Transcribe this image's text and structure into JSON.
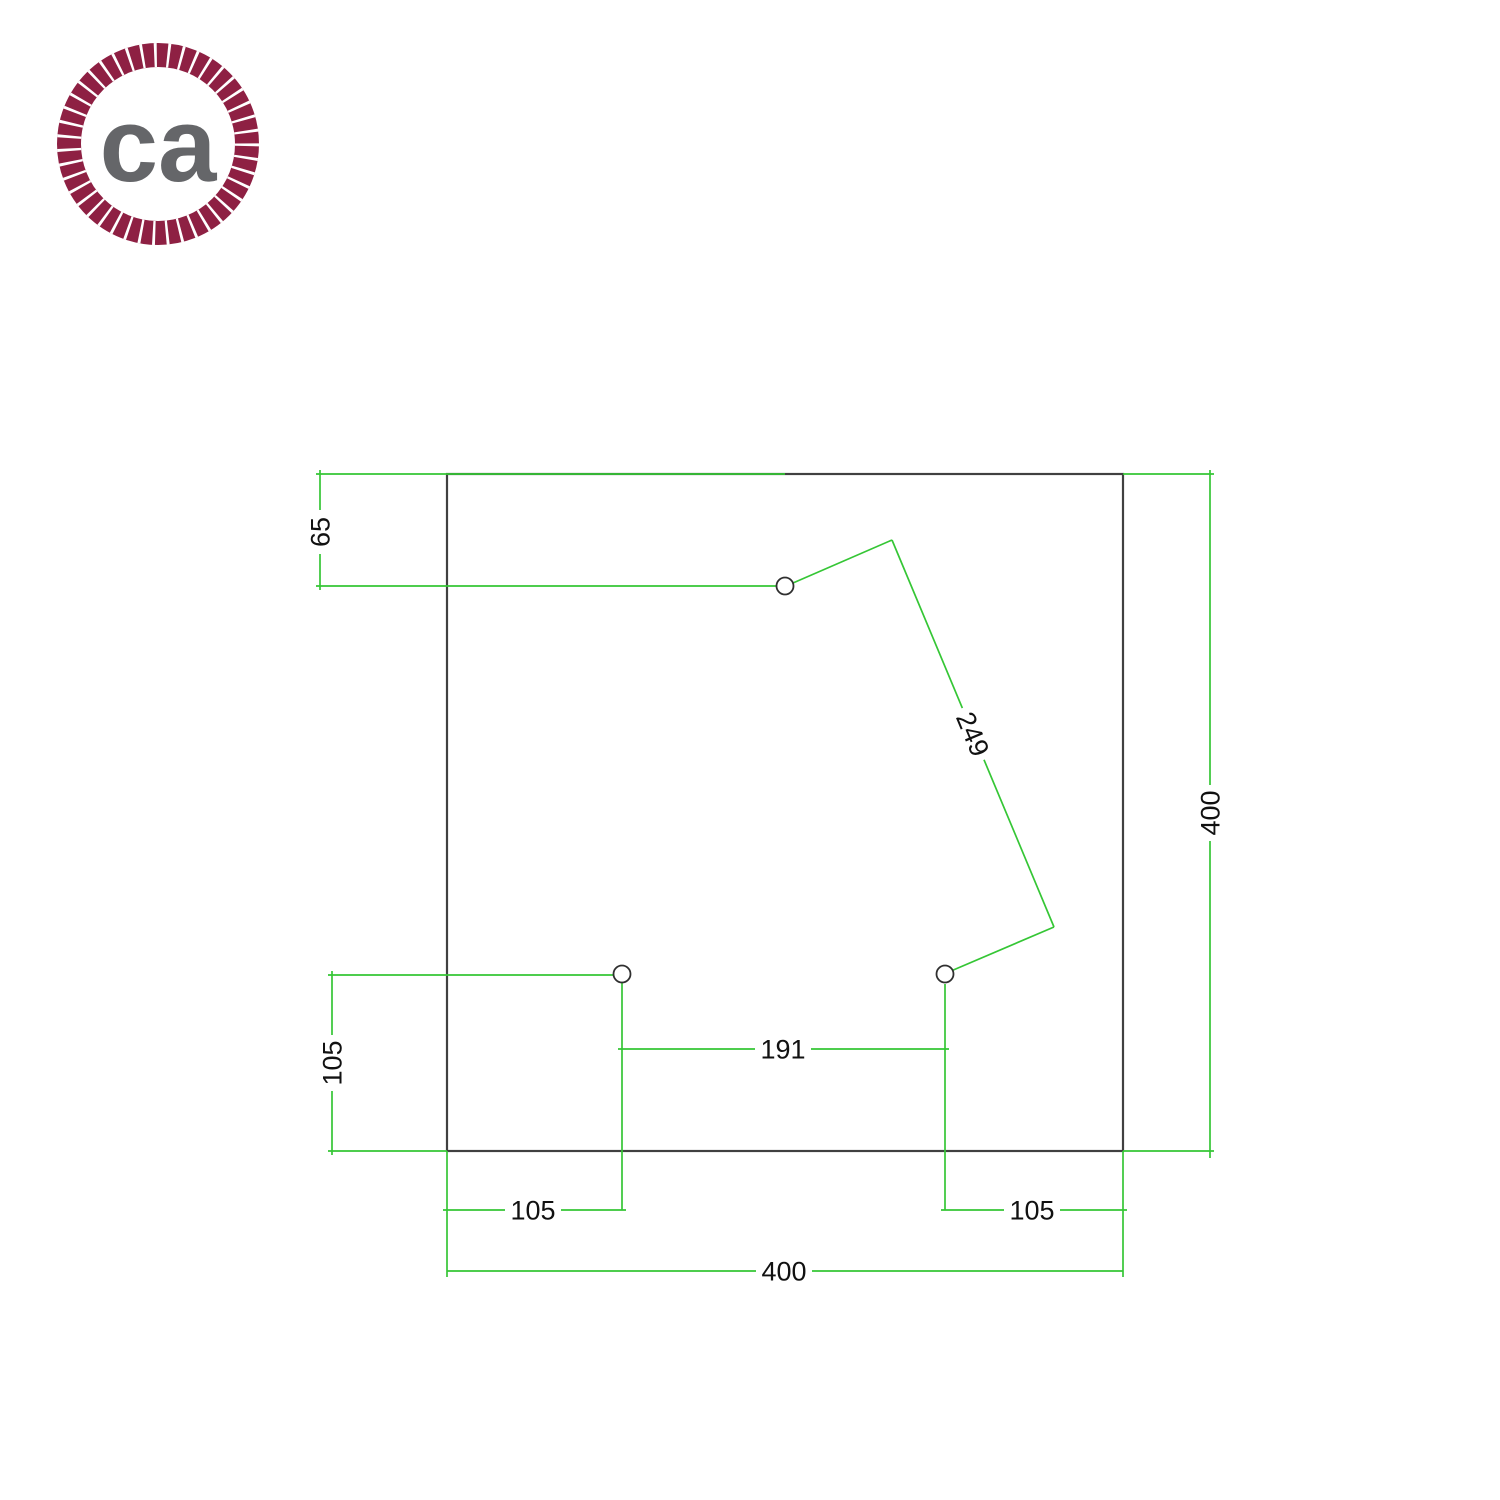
{
  "page": {
    "background": "#ffffff",
    "description": "Technical drilling template drawing of a square ceiling rose plate with 3 holes and CAD-style dimension lines"
  },
  "logo": {
    "text": "ca",
    "ring_color": "#8e2043",
    "text_color": "#656669"
  },
  "drawing": {
    "outline_color": "#404040",
    "dimension_line_color": "#35c635",
    "dimension_text_color": "#111111",
    "plate_shape": "square",
    "hole_count": 3,
    "labels": {
      "top_hole_offset": "65",
      "left_hole_offset": "105",
      "holes_spacing": "191",
      "diagonal_spacing": "249",
      "bottom_left_offset": "105",
      "bottom_right_offset": "105",
      "overall_width": "400",
      "overall_height": "400"
    }
  }
}
